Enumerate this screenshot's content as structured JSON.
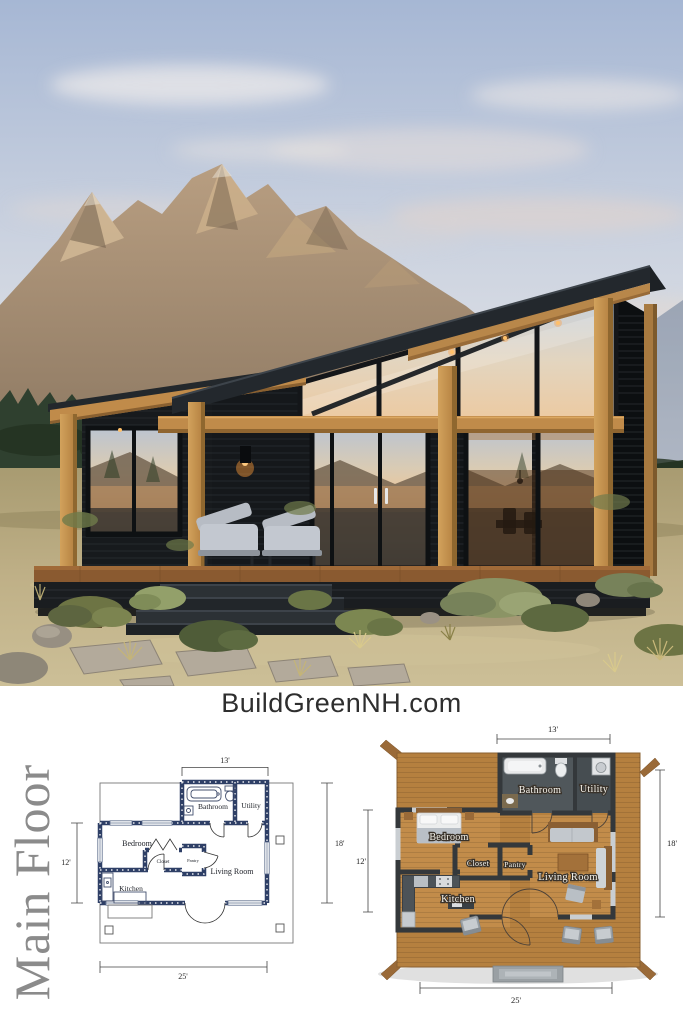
{
  "branding": {
    "website": "BuildGreenNH.com"
  },
  "plan_section": {
    "title": "Main Floor",
    "dimensions": {
      "top": "13'",
      "right": "18'",
      "left": "12'",
      "bottom": "25'"
    },
    "rooms": {
      "bathroom": "Bathroom",
      "utility": "Utility",
      "bedroom": "Bedroom",
      "closet": "Closet",
      "pantry": "Pantry",
      "living_room": "Living Room",
      "kitchen": "Kitchen"
    }
  },
  "colors": {
    "plan_wall_navy": "#2e3f66",
    "plan_title_gray": "#8b8b8b",
    "wood_deck": "#b5803f",
    "charcoal_wall": "#34383b",
    "cabin_siding": "#15181b",
    "cabin_wood": "#c79552"
  }
}
